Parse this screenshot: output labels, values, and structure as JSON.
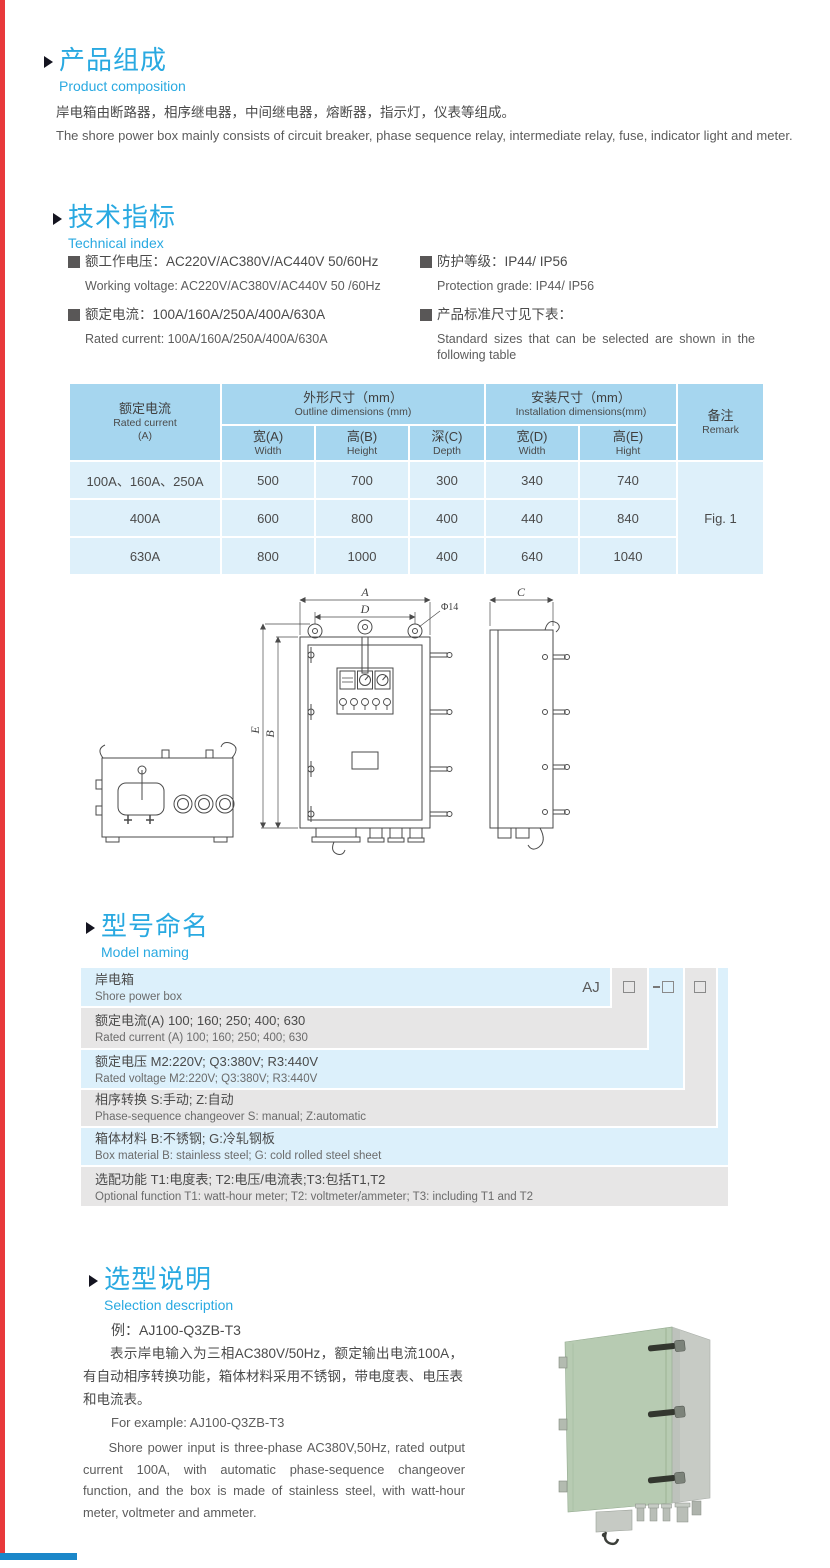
{
  "page": {
    "accent_blue": "#29a9e1",
    "left_rule_color": "#e8393b",
    "bottom_rule_color": "#1b87c9",
    "table_header_bg": "#a6d6ef",
    "table_row_bg": "#def0fa",
    "naming_blue_bg": "#dcf0fb",
    "naming_gray_bg": "#e7e6e6"
  },
  "composition": {
    "title_zh": "产品组成",
    "title_en": "Product  composition",
    "body_zh": "岸电箱由断路器，相序继电器，中间继电器，熔断器，指示灯，仪表等组成。",
    "body_en": "The shore power box mainly consists of circuit breaker, phase sequence relay, intermediate relay, fuse, indicator light and meter."
  },
  "technical": {
    "title_zh": "技术指标",
    "title_en": "Technical index",
    "specs": [
      {
        "zh": "额工作电压：AC220V/AC380V/AC440V  50/60Hz",
        "en": "Working voltage: AC220V/AC380V/AC440V 50 /60Hz"
      },
      {
        "zh": "额定电流：100A/160A/250A/400A/630A",
        "en": "Rated current: 100A/160A/250A/400A/630A"
      },
      {
        "zh": "防护等级：IP44/ IP56",
        "en": "Protection grade: IP44/ IP56"
      },
      {
        "zh": "产品标准尺寸见下表：",
        "en": "Standard sizes that can be selected are shown in the following table"
      }
    ]
  },
  "size_table": {
    "rated_zh": "额定电流",
    "rated_en": "Rated current",
    "rated_unit": "(A)",
    "outline_zh": "外形尺寸（mm）",
    "outline_en": "Outline dimensions (mm)",
    "install_zh": "安装尺寸（mm）",
    "install_en": "Installation dimensions(mm)",
    "remark_zh": "备注",
    "remark_en": "Remark",
    "cols": [
      {
        "zh": "宽(A)",
        "en": "Width"
      },
      {
        "zh": "高(B)",
        "en": "Height"
      },
      {
        "zh": "深(C)",
        "en": "Depth"
      },
      {
        "zh": "宽(D)",
        "en": "Width"
      },
      {
        "zh": "高(E)",
        "en": "Hight"
      }
    ],
    "rows": [
      {
        "current": "100A、160A、250A",
        "values": [
          "500",
          "700",
          "300",
          "340",
          "740"
        ]
      },
      {
        "current": "400A",
        "values": [
          "600",
          "800",
          "400",
          "440",
          "840"
        ]
      },
      {
        "current": "630A",
        "values": [
          "800",
          "1000",
          "400",
          "640",
          "1040"
        ]
      }
    ],
    "remark_value": "Fig. 1"
  },
  "drawing": {
    "dim_a": "A",
    "dim_d": "D",
    "hole": "Φ14",
    "dim_e": "E",
    "dim_b": "B",
    "dim_c": "C"
  },
  "naming": {
    "title_zh": "型号命名",
    "title_en": "Model naming",
    "prefix": "AJ",
    "rows": [
      {
        "zh": "岸电箱",
        "en": "Shore power box"
      },
      {
        "zh": "额定电流(A)  100; 160; 250; 400; 630",
        "en": "Rated current (A) 100; 160; 250; 400; 630"
      },
      {
        "zh": "额定电压  M2:220V;  Q3:380V;  R3:440V",
        "en": "Rated voltage  M2:220V;  Q3:380V;  R3:440V"
      },
      {
        "zh": "相序转换  S:手动; Z:自动",
        "en": "Phase-sequence changeover  S: manual;  Z:automatic"
      },
      {
        "zh": "箱体材料  B:不锈钢;  G:冷轧钢板",
        "en": "Box material   B: stainless steel; G: cold rolled steel sheet"
      },
      {
        "zh": "选配功能  T1:电度表; T2:电压/电流表;T3:包括T1,T2",
        "en": "Optional function  T1: watt-hour meter; T2: voltmeter/ammeter; T3: including T1 and T2"
      }
    ]
  },
  "selection": {
    "title_zh": "选型说明",
    "title_en": "Selection description",
    "example_zh": "例：AJ100-Q3ZB-T3",
    "para_zh": "表示岸电输入为三相AC380V/50Hz，额定输出电流100A，有自动相序转换功能，箱体材料采用不锈钢，带电度表、电压表和电流表。",
    "example_en": "For example: AJ100-Q3ZB-T3",
    "para_en": "Shore power input is three-phase AC380V,50Hz, rated output current 100A, with automatic phase-sequence changeover function, and the box is made of stainless steel, with watt-hour meter, voltmeter and ammeter."
  }
}
